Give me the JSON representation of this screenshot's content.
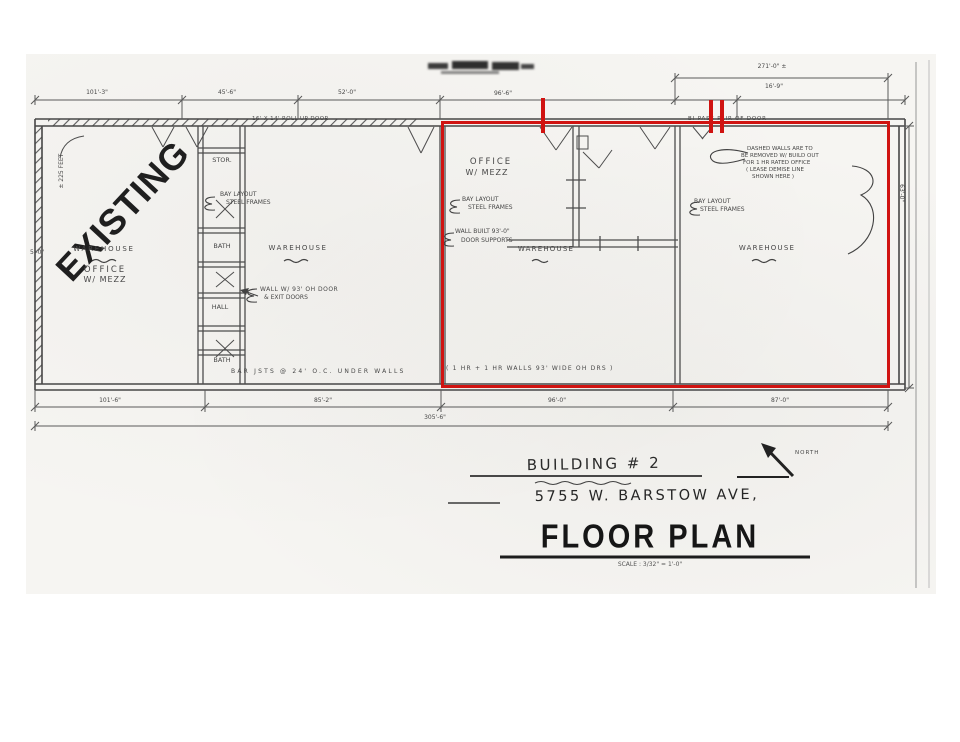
{
  "colors": {
    "ink": "#474747",
    "red_annotation": "#d01311",
    "paper": "#f6f5f2"
  },
  "stamp": "EXISTING",
  "rooms": {
    "warehouse_1": "WAREHOUSE",
    "office_1": [
      "OFFICE",
      "W/ MEZZ"
    ],
    "stor": "STOR.",
    "bath_top": "BATH",
    "hall": "HALL",
    "bath_bottom": "BATH",
    "warehouse_2": "WAREHOUSE",
    "office_2": [
      "OFFICE",
      "W/ MEZZ"
    ],
    "warehouse_3": "WAREHOUSE",
    "warehouse_4": "WAREHOUSE"
  },
  "notes": {
    "roll_up_door": "16' X 14' ROLL UP DOOR",
    "bay_layout_2": [
      "BAY LAYOUT",
      "STEEL FRAMES"
    ],
    "wall_oh_door": [
      "WALL W/ 93' OH DOOR",
      "& EXIT DOORS"
    ],
    "bay_layout_3": [
      "BAY LAYOUT",
      "STEEL FRAMES"
    ],
    "wall_built": [
      "WALL BUILT 93'-0\"",
      "DOOR SUPPORTS"
    ],
    "bi_pass": "BI-PASS PAIR OF DOOR",
    "dashed_walls": [
      "DASHED WALLS ARE TO",
      "BE REMOVED W/ BUILD OUT",
      "FOR 1 HR RATED OFFICE",
      "( LEASE DEMISE LINE",
      "SHOWN HERE )"
    ],
    "bay_layout_4": [
      "BAY LAYOUT",
      "STEEL FRAMES"
    ],
    "bar_joists": "BAR JSTS @ 24' O.C. UNDER WALLS",
    "one_hr_walls": "( 1 HR + 1 HR WALLS 93' WIDE OH DRS )",
    "left_height": "± 225 FEET",
    "left_small": "5'-0\""
  },
  "dimensions": {
    "top": [
      "101'-3\"",
      "45'-6\"",
      "52'-0\"",
      "96'-6\""
    ],
    "top_right_overall": "271'-0\" ±",
    "top_right_segment": "16'-9\"",
    "bottom_segments": [
      "101'-6\"",
      "85'-2\"",
      "96'-0\"",
      "87'-0\""
    ],
    "bottom_overall": "305'-6\"",
    "right_height": "63'-0\""
  },
  "title_block": {
    "building": "BUILDING # 2",
    "address": "5755 W. BARSTOW AVE,",
    "title": "FLOOR PLAN",
    "scale": "SCALE : 3/32\" = 1'-0\"",
    "north": "NORTH"
  }
}
